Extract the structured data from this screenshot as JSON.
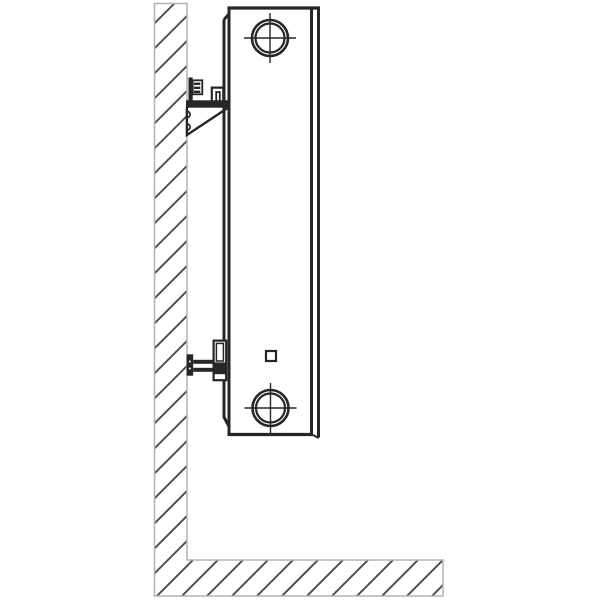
{
  "canvas": {
    "width": 600,
    "height": 600,
    "background": "#ffffff"
  },
  "colors": {
    "outline": "#262626",
    "wall_border": "#b3b3b3",
    "hatch": "#4a4a4a",
    "surface": "#ffffff"
  },
  "diagram": {
    "type": "technical-line-drawing",
    "subject": "panel-radiator-side-view-wall-mounting",
    "components": {
      "wall": "hatched-wall-and-floor-section",
      "radiator": "panel-radiator-side-profile",
      "upper_bracket": "upper-wall-bracket-with-serrated-clip",
      "lower_bracket": "lower-wall-bracket-with-support-rod",
      "top_port": "top-connection-port-crosshair",
      "bottom_port": "bottom-connection-port-crosshair",
      "vent_square": "small-square-vent-opening"
    }
  }
}
